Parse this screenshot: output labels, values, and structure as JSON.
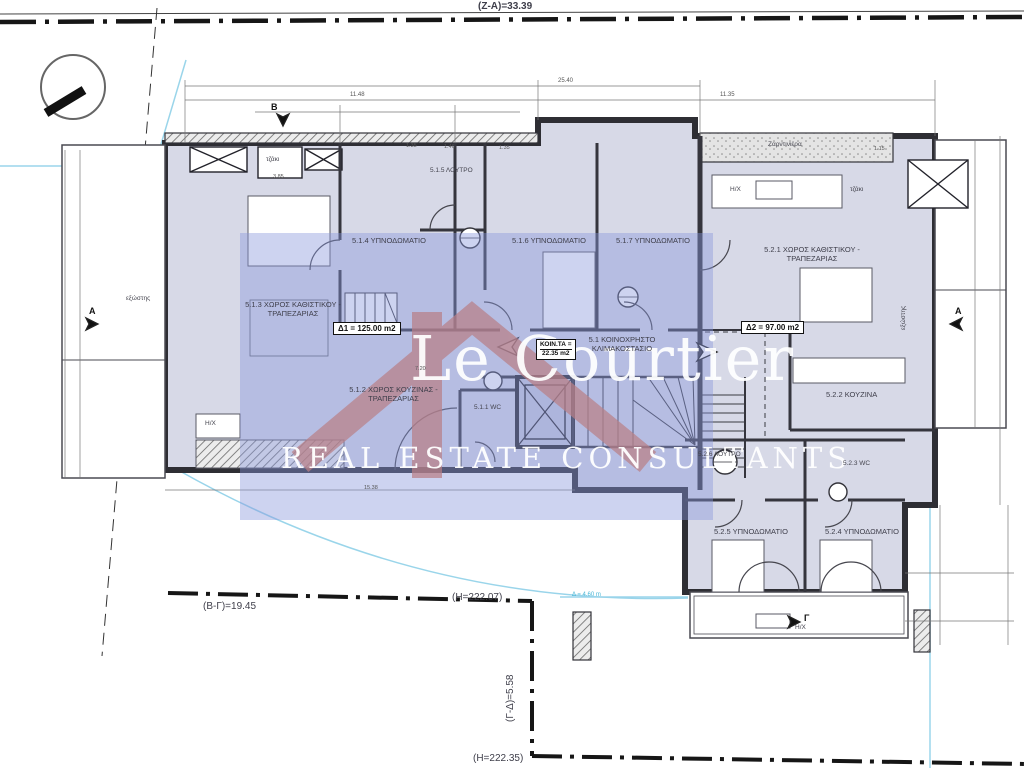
{
  "site": {
    "boundary_top_label": "(Z-A)=33.39",
    "boundary_bottom_label": "(B-Γ)=19.45",
    "boundary_side_label": "(Γ-Δ)=5.58",
    "elevation_1": "(H=222.07)",
    "elevation_2": "(H=222.35)",
    "contour_label": "Δ = 4.60 m"
  },
  "rooms": {
    "r513": "5.1.3 ΧΩΡΟΣ ΚΑΘΙΣΤΙΚΟΥ - ΤΡΑΠΕΖΑΡΙΑΣ",
    "r514": "5.1.4 ΥΠΝΟΔΩΜΑΤΙΟ",
    "r515": "5.1.5 ΛΟΥΤΡΟ",
    "r516": "5.1.6 ΥΠΝΟΔΩΜΑΤΙΟ",
    "r517": "5.1.7 ΥΠΝΟΔΩΜΑΤΙΟ",
    "r512": "5.1.2 ΧΩΡΟΣ ΚΟΥΖΙΝΑΣ - ΤΡΑΠΕΖΑΡΙΑΣ",
    "r511": "5.1.1 WC",
    "r51stair": "5.1 ΚΟΙΝΟΧΡΗΣΤΟ ΚΛΙΜΑΚΟΣΤΑΣΙΟ",
    "r521": "5.2.1 ΧΩΡΟΣ ΚΑΘΙΣΤΙΚΟΥ - ΤΡΑΠΕΖΑΡΙΑΣ",
    "r522": "5.2.2 ΚΟΥΖΙΝΑ",
    "r523": "5.2.3 WC",
    "r526": "5.2.6 ΛΟΥΤΡΟ",
    "r525": "5.2.5 ΥΠΝΟΔΩΜΑΤΙΟ",
    "r524": "5.2.4 ΥΠΝΟΔΩΜΑΤΙΟ"
  },
  "areas": {
    "d1": "Δ1 = 125.00 m2",
    "d2": "Δ2 = 97.00 m2",
    "common_line1": "ΚΟΙΝ.ΤΑ =",
    "common_line2": "22.35 m2"
  },
  "annotations": {
    "fireplace": "τζάκι",
    "planter": "Ζαρντινιέρα",
    "balcony": "εξώστης",
    "hx": "H/X",
    "marker_a": "A",
    "marker_b": "B",
    "marker_g": "Γ"
  },
  "dimensions": {
    "top_total": "25.40",
    "top_left": "11.48",
    "top_right": "11.35",
    "w1": "1.35",
    "w2": "1.46",
    "w3": "1.35",
    "w4": "3.85",
    "w5": "7.20",
    "w6": "15.38",
    "w7": "1.15"
  },
  "watermark": {
    "brand": "Le Courtier",
    "tagline": "REAL ESTATE CONSULTANTS"
  },
  "colors": {
    "room_fill": "#d7d9e7",
    "watermark_panel": "#8796dc",
    "watermark_accent": "#dc6f4a",
    "boundary_cyan": "#8fd0e8"
  }
}
